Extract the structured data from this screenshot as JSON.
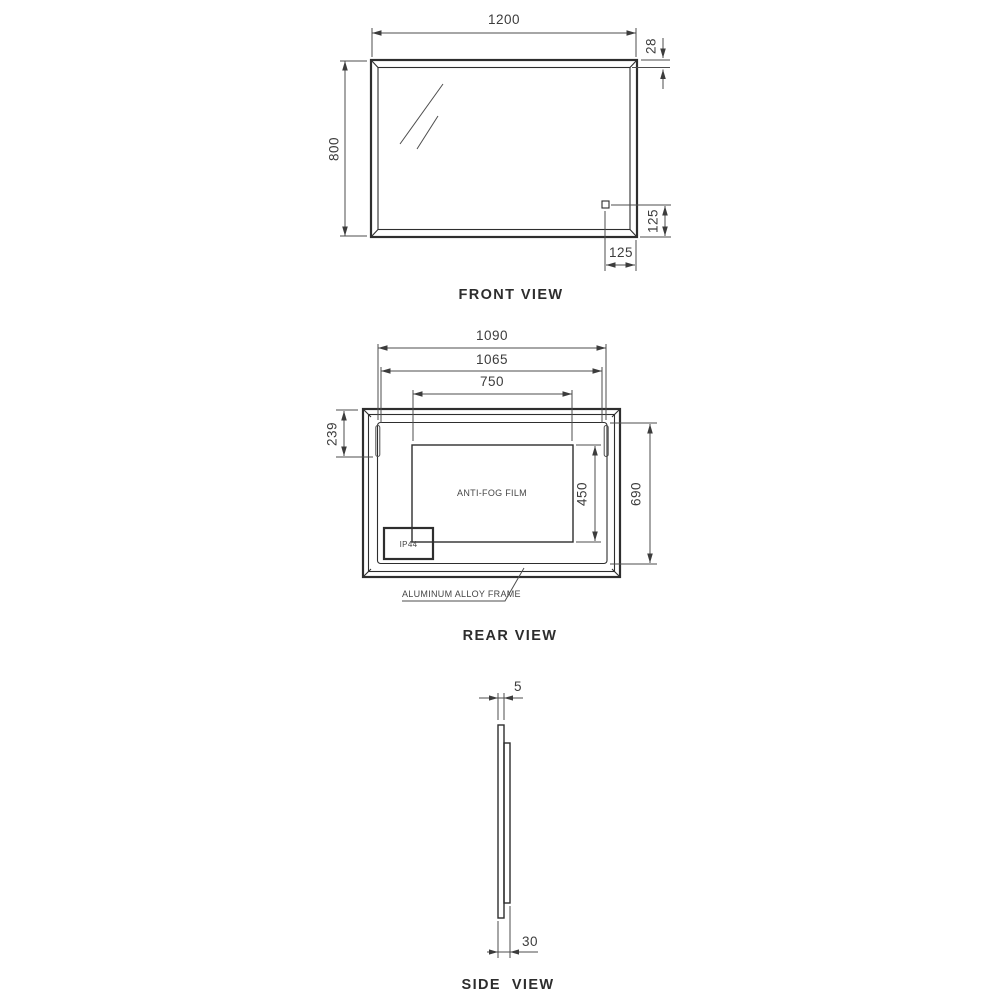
{
  "front_view": {
    "label": "FRONT VIEW",
    "dim_width": "1200",
    "dim_height": "800",
    "dim_frame_bevel": "28",
    "dim_sensor_from_bottom": "125",
    "dim_sensor_from_right": "125"
  },
  "rear_view": {
    "label": "REAR VIEW",
    "dim_backplate_width": "1090",
    "dim_inner_width": "1065",
    "dim_film_width": "750",
    "dim_top_offset": "239",
    "dim_film_height": "450",
    "dim_backplate_height": "690",
    "film_label": "ANTI-FOG FILM",
    "ip_rating": "IP44",
    "frame_note": "ALUMINUM ALLOY FRAME"
  },
  "side_view": {
    "label": "SIDE  VIEW",
    "dim_glass_thickness": "5",
    "dim_depth": "30"
  },
  "colors": {
    "line": "#2e2e2e",
    "dimension_line": "#4e4e4e",
    "text": "#3c3c3c",
    "background": "#ffffff"
  }
}
